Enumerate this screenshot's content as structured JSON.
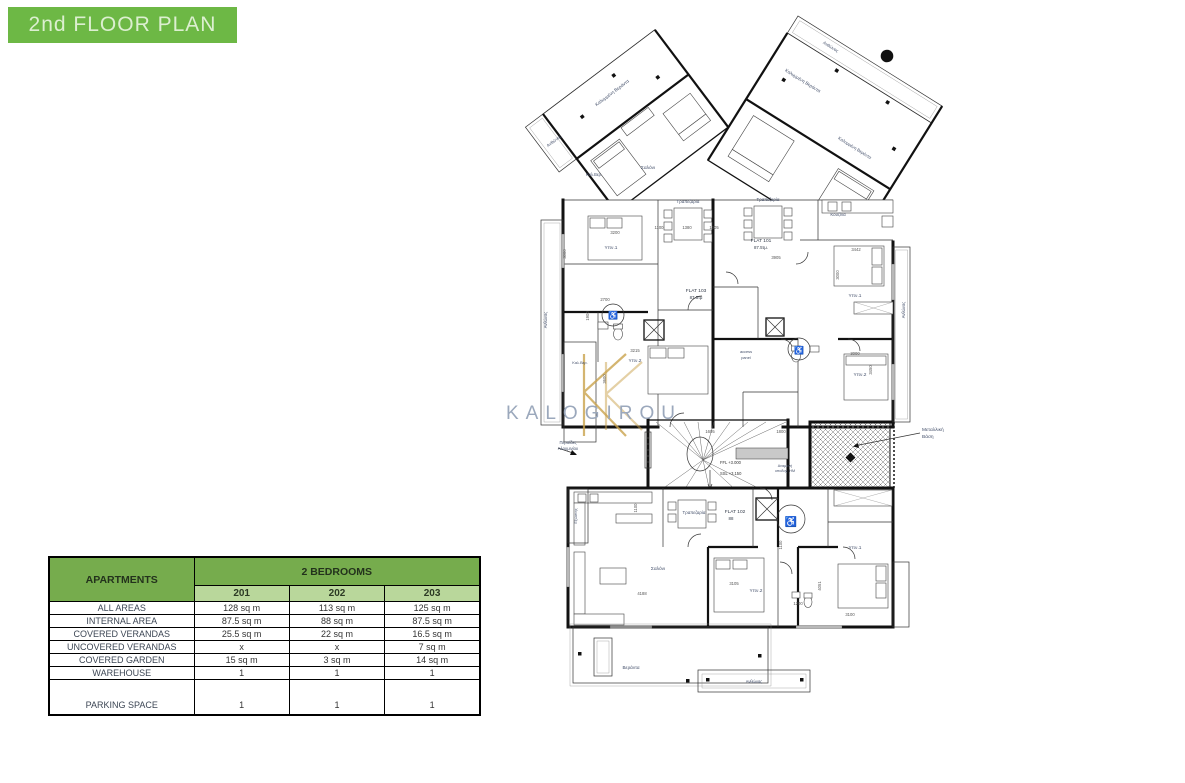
{
  "title": {
    "text": "2nd FLOOR PLAN"
  },
  "colors": {
    "label": "#44506b",
    "dim": "#555555",
    "css": {
      "green-title": "#6db845",
      "green-header": "#76ac4d",
      "green-sub": "#b9d79b",
      "pale-title-text": "#dcefd0",
      "table-border": "#000000"
    }
  },
  "watermark": {
    "text": "KALOGIROU",
    "color": "#9ba8bc",
    "monogram_color": "#c9a24c"
  },
  "table": {
    "corner_label": "APARTMENTS",
    "group_header": "2 BEDROOMS",
    "columns": [
      "201",
      "202",
      "203"
    ],
    "rows": [
      {
        "label": "ALL AREAS",
        "values": [
          "128 sq m",
          "113 sq m",
          "125 sq m"
        ]
      },
      {
        "label": "INTERNAL AREA",
        "values": [
          "87.5 sq m",
          "88 sq m",
          "87.5 sq m"
        ]
      },
      {
        "label": "COVERED VERANDAS",
        "values": [
          "25.5 sq m",
          "22 sq m",
          "16.5 sq m"
        ]
      },
      {
        "label": "UNCOVERED VERANDAS",
        "values": [
          "x",
          "x",
          "7 sq m"
        ]
      },
      {
        "label": "COVERED GARDEN",
        "values": [
          "15 sq m",
          "3 sq m",
          "14 sq m"
        ]
      },
      {
        "label": "WAREHOUSE",
        "values": [
          "1",
          "1",
          "1"
        ]
      },
      {
        "label": "PARKING SPACE",
        "values": [
          "1",
          "1",
          "1"
        ],
        "tall": true
      }
    ]
  },
  "floorplan": {
    "labels": [
      {
        "t": "Ανθώνας",
        "x": 57,
        "y": 140,
        "rot": -37,
        "size": 4.3,
        "name": "label-anthonas-left"
      },
      {
        "t": "Καλυμμένη Βεράντα",
        "x": 115,
        "y": 92,
        "rot": -37,
        "size": 4.6,
        "name": "label-covered-veranda-1"
      },
      {
        "t": "Καλ.Βερ.",
        "x": 96,
        "y": 174,
        "size": 4.1,
        "name": "label-kal-ver-1"
      },
      {
        "t": "Σαλόνι",
        "x": 150,
        "y": 167,
        "size": 4.8,
        "name": "label-living-1"
      },
      {
        "t": "Ανθώνας",
        "x": 332,
        "y": 46,
        "rot": 32,
        "size": 4.3,
        "name": "label-anthonas-top-right"
      },
      {
        "t": "Καλυμμένη Βεράντα",
        "x": 304,
        "y": 80,
        "rot": 32,
        "size": 4.6,
        "name": "label-covered-veranda-2"
      },
      {
        "t": "Καλυμμένη Βεράντα",
        "x": 356,
        "y": 147,
        "rot": 32,
        "size": 4.3,
        "name": "label-covered-veranda-3"
      },
      {
        "t": "Τραπεζαρία",
        "x": 190,
        "y": 201,
        "size": 4.4,
        "name": "label-dining-1"
      },
      {
        "t": "Τραπεζαρία",
        "x": 270,
        "y": 199,
        "size": 4.4,
        "name": "label-dining-2"
      },
      {
        "t": "Κουζίνα",
        "x": 340,
        "y": 214,
        "size": 4.4,
        "name": "label-kitchen-1"
      },
      {
        "t": "FLAT 101",
        "x": 263,
        "y": 240,
        "size": 4.8,
        "color": "#333b49",
        "name": "label-flat-101"
      },
      {
        "t": "87.5τμ.",
        "x": 263,
        "y": 247,
        "size": 4.4,
        "color": "#333b49",
        "name": "label-flat-101-area"
      },
      {
        "t": "FLAT 103",
        "x": 198,
        "y": 290,
        "size": 4.8,
        "color": "#333b49",
        "name": "label-flat-103"
      },
      {
        "t": "87.5τμ",
        "x": 198,
        "y": 297,
        "size": 4.4,
        "color": "#333b49",
        "name": "label-flat-103-area"
      },
      {
        "t": "Υπν.1",
        "x": 113,
        "y": 247,
        "size": 4.8,
        "name": "label-bed1-flat103"
      },
      {
        "t": "Υπν.1",
        "x": 357,
        "y": 295,
        "size": 4.8,
        "name": "label-bed1-flat101"
      },
      {
        "t": "Υπν.2",
        "x": 137,
        "y": 360,
        "size": 4.8,
        "name": "label-bed2-flat103"
      },
      {
        "t": "Υπν.2",
        "x": 362,
        "y": 374,
        "size": 4.8,
        "name": "label-bed2-flat101"
      },
      {
        "t": "access",
        "x": 248,
        "y": 351,
        "size": 3.9,
        "name": "label-access"
      },
      {
        "t": "panel",
        "x": 248,
        "y": 357,
        "size": 3.9,
        "name": "label-panel"
      },
      {
        "t": "Περσίδες",
        "x": 70,
        "y": 442,
        "size": 4.2,
        "name": "label-louvers-1"
      },
      {
        "t": "Αλουμινίου",
        "x": 70,
        "y": 448,
        "size": 4.2,
        "name": "label-louvers-2"
      },
      {
        "t": "FFL +3.000",
        "x": 222,
        "y": 462,
        "size": 4.1,
        "color": "#333333",
        "anchor": "start",
        "name": "label-ffl"
      },
      {
        "t": "SSL +3.150",
        "x": 222,
        "y": 473,
        "size": 4.1,
        "color": "#333333",
        "anchor": "start",
        "name": "label-ssl"
      },
      {
        "t": "Αναμονή",
        "x": 287,
        "y": 465,
        "size": 3.7,
        "name": "label-anamoni"
      },
      {
        "t": "υποδοχ. ΗΜ",
        "x": 287,
        "y": 470,
        "size": 3.7,
        "name": "label-ypodoxi"
      },
      {
        "t": "Μεταλλική",
        "x": 424,
        "y": 429,
        "size": 4.8,
        "anchor": "start",
        "name": "label-metal-base-1"
      },
      {
        "t": "Βάση",
        "x": 424,
        "y": 436,
        "size": 4.8,
        "anchor": "start",
        "name": "label-metal-base-2"
      },
      {
        "t": "FLAT 102",
        "x": 237,
        "y": 511,
        "size": 4.8,
        "color": "#333b49",
        "name": "label-flat-102"
      },
      {
        "t": "88",
        "x": 233,
        "y": 518,
        "size": 4.4,
        "color": "#333b49",
        "name": "label-flat-102-area"
      },
      {
        "t": "Τραπεζαρία",
        "x": 196,
        "y": 512,
        "size": 4.4,
        "name": "label-dining-3"
      },
      {
        "t": "Σαλόνι",
        "x": 160,
        "y": 568,
        "size": 4.8,
        "name": "label-living-2"
      },
      {
        "t": "Υπν.2",
        "x": 258,
        "y": 590,
        "size": 4.8,
        "name": "label-bed2-flat102"
      },
      {
        "t": "Υπν.1",
        "x": 357,
        "y": 547,
        "size": 4.8,
        "name": "label-bed1-flat102"
      },
      {
        "t": "Βεράντα",
        "x": 133,
        "y": 667,
        "size": 4.6,
        "name": "label-veranda-bottom"
      },
      {
        "t": "Ανθώνας",
        "x": 256,
        "y": 681,
        "size": 4.1,
        "name": "label-anthonas-bottom"
      },
      {
        "t": "Ανθώνας",
        "x": 49,
        "y": 318,
        "rot": -90,
        "size": 4.1,
        "name": "label-anthonas-west"
      },
      {
        "t": "Ανθώνας",
        "x": 407,
        "y": 308,
        "rot": -90,
        "size": 4.1,
        "name": "label-anthonas-east"
      },
      {
        "t": "Καλ.Βερ.",
        "x": 82,
        "y": 362,
        "size": 3.9,
        "name": "label-kal-ver-2"
      },
      {
        "t": "Εξώστης",
        "x": 79,
        "y": 514,
        "rot": -90,
        "size": 3.9,
        "name": "label-exostis"
      },
      {
        "t": "♿",
        "x": 115,
        "y": 316,
        "size": 8,
        "color": "#111111",
        "name": "wheelchair-icon"
      },
      {
        "t": "♿",
        "x": 301,
        "y": 351,
        "size": 8,
        "color": "#111111",
        "name": "wheelchair-icon"
      },
      {
        "t": "♿",
        "x": 293,
        "y": 523,
        "size": 10,
        "color": "#111111",
        "name": "wheelchair-icon"
      },
      {
        "t": "3200",
        "x": 117,
        "y": 232,
        "size": 4.2,
        "color": "#555555",
        "name": "dim-label"
      },
      {
        "t": "1100",
        "x": 161,
        "y": 227,
        "size": 4.2,
        "color": "#555555",
        "name": "dim-label"
      },
      {
        "t": "1380",
        "x": 189,
        "y": 227,
        "size": 4.2,
        "color": "#555555",
        "name": "dim-label"
      },
      {
        "t": "1305",
        "x": 216,
        "y": 227,
        "size": 4.2,
        "color": "#555555",
        "name": "dim-label"
      },
      {
        "t": "3905",
        "x": 278,
        "y": 257,
        "size": 4.2,
        "color": "#555555",
        "name": "dim-label"
      },
      {
        "t": "3442",
        "x": 358,
        "y": 249,
        "size": 4.2,
        "color": "#555555",
        "name": "dim-label"
      },
      {
        "t": "3000",
        "x": 341,
        "y": 273,
        "rot": -90,
        "size": 4.2,
        "color": "#555555",
        "name": "dim-label"
      },
      {
        "t": "3000",
        "x": 68,
        "y": 252,
        "rot": -90,
        "size": 4.2,
        "color": "#555555",
        "name": "dim-label"
      },
      {
        "t": "2700",
        "x": 107,
        "y": 299,
        "size": 4.2,
        "color": "#555555",
        "name": "dim-label"
      },
      {
        "t": "1900",
        "x": 91,
        "y": 314,
        "rot": -90,
        "size": 4.2,
        "color": "#555555",
        "name": "dim-label"
      },
      {
        "t": "3215",
        "x": 137,
        "y": 350,
        "size": 4.2,
        "color": "#555555",
        "name": "dim-label"
      },
      {
        "t": "3600",
        "x": 108,
        "y": 377,
        "rot": -90,
        "size": 4.2,
        "color": "#555555",
        "name": "dim-label"
      },
      {
        "t": "3000",
        "x": 357,
        "y": 353,
        "size": 4.2,
        "color": "#555555",
        "name": "dim-label"
      },
      {
        "t": "3450",
        "x": 374,
        "y": 368,
        "rot": -90,
        "size": 4.2,
        "color": "#555555",
        "name": "dim-label"
      },
      {
        "t": "1605",
        "x": 212,
        "y": 431,
        "size": 4.2,
        "color": "#555555",
        "name": "dim-label"
      },
      {
        "t": "1800",
        "x": 283,
        "y": 431,
        "size": 4.2,
        "color": "#555555",
        "name": "dim-label"
      },
      {
        "t": "3105",
        "x": 236,
        "y": 583,
        "size": 4.2,
        "color": "#555555",
        "name": "dim-label"
      },
      {
        "t": "4188",
        "x": 144,
        "y": 593,
        "size": 4.2,
        "color": "#555555",
        "name": "dim-label"
      },
      {
        "t": "4051",
        "x": 323,
        "y": 584,
        "rot": -90,
        "size": 4.2,
        "color": "#555555",
        "name": "dim-label"
      },
      {
        "t": "1100",
        "x": 284,
        "y": 543,
        "rot": -90,
        "size": 4.2,
        "color": "#555555",
        "name": "dim-label"
      },
      {
        "t": "1200",
        "x": 300,
        "y": 603,
        "size": 4.2,
        "color": "#555555",
        "name": "dim-label"
      },
      {
        "t": "3100",
        "x": 352,
        "y": 614,
        "size": 4.2,
        "color": "#555555",
        "name": "dim-label"
      },
      {
        "t": "1100",
        "x": 139,
        "y": 506,
        "rot": -90,
        "size": 4.2,
        "color": "#555555",
        "name": "dim-label"
      },
      {
        "t": "KALOGIROU",
        "x": 96,
        "y": 417,
        "size": 19,
        "color": "#9ba8bc",
        "ls": 7,
        "name": "watermark-text"
      }
    ]
  }
}
